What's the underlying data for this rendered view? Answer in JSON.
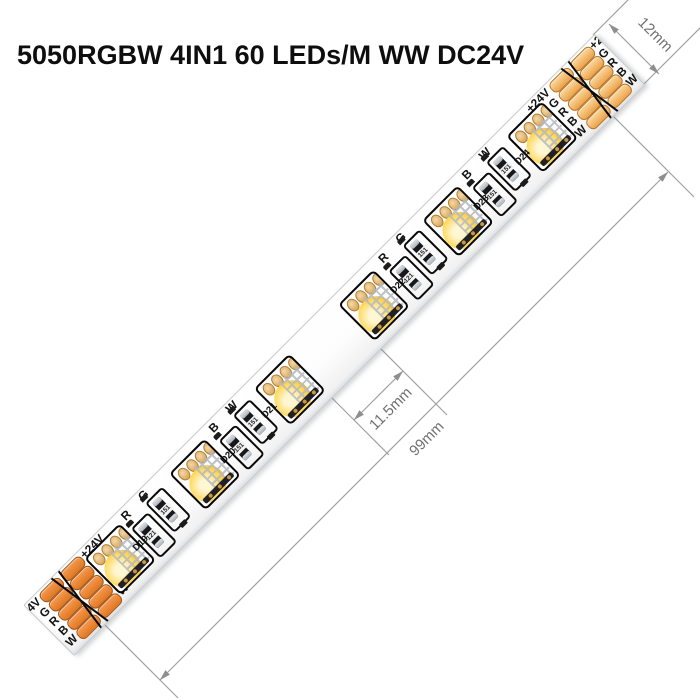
{
  "title": "5050RGBW 4IN1 60 LEDs/M WW DC24V",
  "annotations": {
    "strip_width": "12mm",
    "led_gap": "11.5mm",
    "segment_length": "99mm"
  },
  "ends": {
    "left": {
      "col1_labels": [
        "+24V",
        "G",
        "R",
        "B",
        "W"
      ],
      "col2_labels": [
        "+24V",
        "G",
        "R",
        "B",
        "W"
      ]
    },
    "right": {
      "col1_labels": [
        "+24V",
        "G",
        "R",
        "B",
        "W"
      ],
      "col2_labels": [
        "+24V",
        "G",
        "R",
        "B",
        "W"
      ]
    }
  },
  "groups": [
    {
      "letters": [
        "R",
        "G"
      ],
      "codes": [
        "121",
        "151"
      ],
      "d_labels": [
        "D19"
      ]
    },
    {
      "letters": [
        "B",
        "W"
      ],
      "codes": [
        "151",
        "151"
      ],
      "d_labels": [
        "D20",
        "D21"
      ]
    },
    {
      "letters": [
        "R",
        "G"
      ],
      "codes": [
        "121",
        "151"
      ],
      "d_labels": [
        "D22"
      ]
    },
    {
      "letters": [
        "B",
        "W"
      ],
      "codes": [
        "151",
        "151"
      ],
      "d_labels": [
        "D23",
        "D24"
      ]
    }
  ],
  "led_count": 6,
  "colors": {
    "pad_orange": "#e8883c",
    "pad_orange_border": "#a2551a",
    "pad_light": "#f6cf8e",
    "phosphor_yellow": "#ffd95e",
    "silkscreen_black": "#0a0a0a",
    "dimension_line_gray": "#a2a2a2",
    "dimension_text_gray": "#707070"
  }
}
